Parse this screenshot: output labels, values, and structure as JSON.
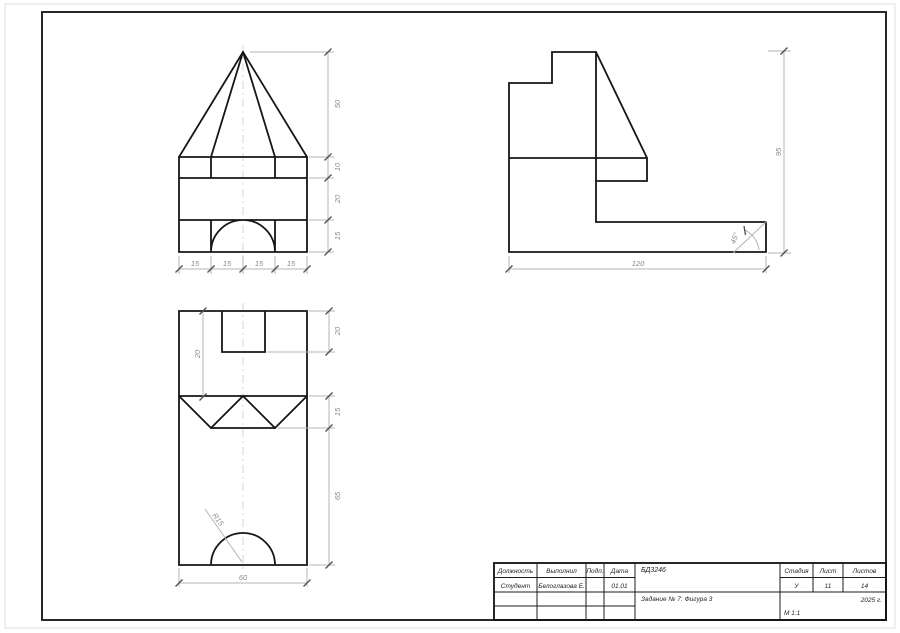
{
  "title_block": {
    "headers": {
      "position": "Должность",
      "completed_by": "Выполнил",
      "signature": "Подп.",
      "date": "Дата",
      "stage": "Стадия",
      "sheet": "Лист",
      "sheets": "Листов"
    },
    "values": {
      "position": "Студент",
      "completed_by": "Белоглазова Е.",
      "date": "01.01",
      "stage": "У",
      "sheet": "11",
      "sheets": "14"
    },
    "doc_code": "БД3246",
    "task_title": "Задание № 7: Фигура 3",
    "year": "2025 г.",
    "scale": "М 1:1"
  },
  "front_view": {
    "dims_right": [
      "50",
      "10",
      "20",
      "15"
    ],
    "dims_bottom": [
      "15",
      "15",
      "15",
      "15"
    ]
  },
  "side_view": {
    "dim_height": "95",
    "dim_width": "120",
    "angle": "45°"
  },
  "top_view": {
    "dims_right": [
      "20",
      "15",
      "65"
    ],
    "dim_inner": "20",
    "dim_bottom": "60",
    "radius": "R15"
  }
}
